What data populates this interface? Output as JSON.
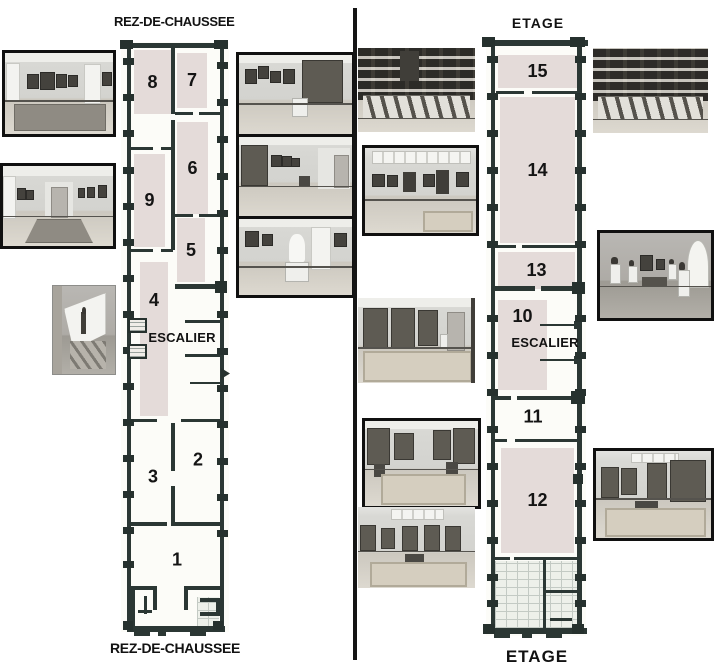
{
  "palette": {
    "wall_dark": "#2b3734",
    "room_fill": "#e4dbd9",
    "hatch_fill": "#edf0ea",
    "divider": "#151515",
    "text": "#121212",
    "paper": "#ffffff"
  },
  "plans": {
    "rdc": {
      "title_top": "REZ-DE-CHAUSSEE",
      "title_bottom": "REZ-DE-CHAUSSEE",
      "escalier": "ESCALIER",
      "rooms": [
        {
          "number": "8"
        },
        {
          "number": "7"
        },
        {
          "number": "6"
        },
        {
          "number": "9"
        },
        {
          "number": "5"
        },
        {
          "number": "4"
        },
        {
          "number": "3"
        },
        {
          "number": "2"
        },
        {
          "number": "1"
        }
      ]
    },
    "etage": {
      "title_top": "ETAGE",
      "title_bottom": "ETAGE",
      "escalier": "ESCALIER",
      "rooms": [
        {
          "number": "15"
        },
        {
          "number": "14"
        },
        {
          "number": "13"
        },
        {
          "number": "10"
        },
        {
          "number": "11"
        },
        {
          "number": "12"
        }
      ]
    }
  },
  "photos": [
    {
      "name": "photo-ground-room-paintings-carpet",
      "depicts": "gallery room with paintings and large dark carpet"
    },
    {
      "name": "photo-ground-long-corridor",
      "depicts": "long gallery corridor with paintings on both walls"
    },
    {
      "name": "photo-ground-staircase-statue",
      "depicts": "staircase with statue silhouette on bright wall"
    },
    {
      "name": "photo-ground-tapestry-pedestal-room",
      "depicts": "room with large tapestry, paintings and sculpture pedestal"
    },
    {
      "name": "photo-ground-tapestry-gallery",
      "depicts": "long gallery with tapestry and framed paintings"
    },
    {
      "name": "photo-ground-white-statue-room",
      "depicts": "room with white marble statue on pedestal"
    },
    {
      "name": "photo-etage-salon-frames-left",
      "depicts": "salon wall crowded with framed drawings and display easels"
    },
    {
      "name": "photo-etage-skylit-gallery",
      "depicts": "skylit gallery with framed paintings and panels"
    },
    {
      "name": "photo-etage-three-tapestries",
      "depicts": "room with three large tapestries and patterned carpet"
    },
    {
      "name": "photo-etage-tapestry-table-lamp",
      "depicts": "tapestry room with table, lamp and carpet"
    },
    {
      "name": "photo-etage-tapestry-skylight",
      "depicts": "skylit tapestry room with small table and carpet"
    },
    {
      "name": "photo-etage-salon-frames-right",
      "depicts": "salon wall crowded with framed drawings and display easels"
    },
    {
      "name": "photo-etage-sculpture-room",
      "depicts": "sculpture room with busts, bench and arched window"
    },
    {
      "name": "photo-etage-tapestry-table-room",
      "depicts": "skylit tapestry room with central table and carpet"
    }
  ]
}
